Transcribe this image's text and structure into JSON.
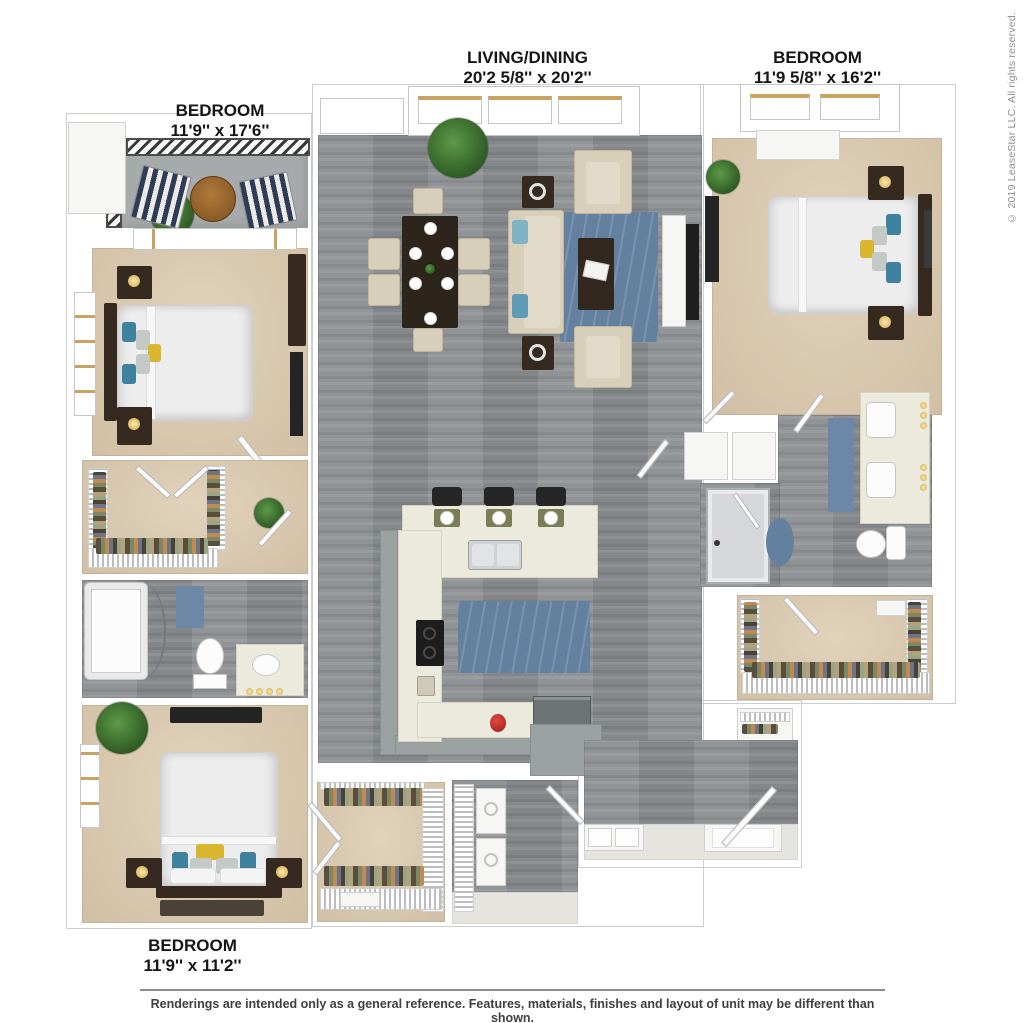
{
  "labels": {
    "bedroom_tl": {
      "title": "BEDROOM",
      "dims": "11'9'' x 17'6''"
    },
    "living": {
      "title": "LIVING/DINING",
      "dims": "20'2 5/8'' x 20'2''"
    },
    "bedroom_tr": {
      "title": "BEDROOM",
      "dims": "11'9 5/8'' x 16'2''"
    },
    "bedroom_b": {
      "title": "BEDROOM",
      "dims": "11'9'' x 11'2''"
    }
  },
  "copyright": {
    "text": "© 2019 LeaseStar LLC. All rights reserved."
  },
  "disclaimer": {
    "text": "Renderings are intended only as a general reference. Features, materials, finishes and layout of unit may be different than shown."
  },
  "colors": {
    "wood_floor": "#8b8e91",
    "carpet_tan": "#dccaae",
    "balcony_concrete": "#a7aaab",
    "area_rug_blue": "#64809f",
    "sofa_cream": "#d8cfba",
    "dark_wood": "#36291f",
    "counter_cream": "#eceadd",
    "cabinet_gray": "#9ba1a1",
    "accent_teal": "#3f82a0",
    "accent_yellow": "#d9b62d",
    "plant_green": "#3f7a33",
    "deck_chair_navy": "#2e3c57",
    "label_text": "#161616",
    "copyright_gray": "#8f8f8f",
    "disclaimer_gray": "#3f3f3f"
  }
}
